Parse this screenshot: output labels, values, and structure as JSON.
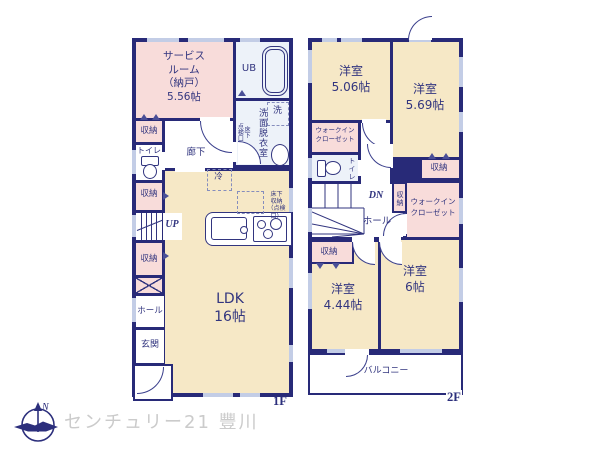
{
  "palette": {
    "wall": "#282a78",
    "room_cream": "#f6e8c6",
    "room_pink": "#f8dcda",
    "bath_blue": "#edf2f9",
    "window_blue": "#c3cde6",
    "logo_gray": "#cbcbcb",
    "text_navy": "#32357f"
  },
  "floor1": {
    "floor_label": "1F",
    "service_room": "サービス\nルーム\n（納戸）\n5.56帖",
    "ub": "UB",
    "washer": "洗",
    "washroom": "洗面脱衣室",
    "underfloor_hatch": "床下\n点検口",
    "storage1": "収納",
    "toilet": "トイレ",
    "corridor": "廊下",
    "fridge": "冷",
    "storage2": "収納",
    "stairs_up": "UP",
    "storage3": "収納",
    "hall": "ホール",
    "entrance": "玄関",
    "ldk": "LDK\n16帖",
    "underfloor_storage": "床下\n収納\n（点検口）"
  },
  "floor2": {
    "floor_label": "2F",
    "room_506": "洋室\n5.06帖",
    "room_569": "洋室\n5.69帖",
    "wic_left": "ウォークイン\nクローゼット",
    "toilet": "トイレ",
    "stairs_down": "DN",
    "closet_mid": "収納",
    "closet_top": "収納",
    "wic_right": "ウォークイン\nクローゼット",
    "hall": "ホール",
    "closet_bottom": "収納",
    "room_444": "洋室\n4.44帖",
    "room_6": "洋室\n6帖",
    "balcony": "バルコニー"
  },
  "branding": {
    "company": "センチュリー21 豐川",
    "compass_n": "N"
  }
}
